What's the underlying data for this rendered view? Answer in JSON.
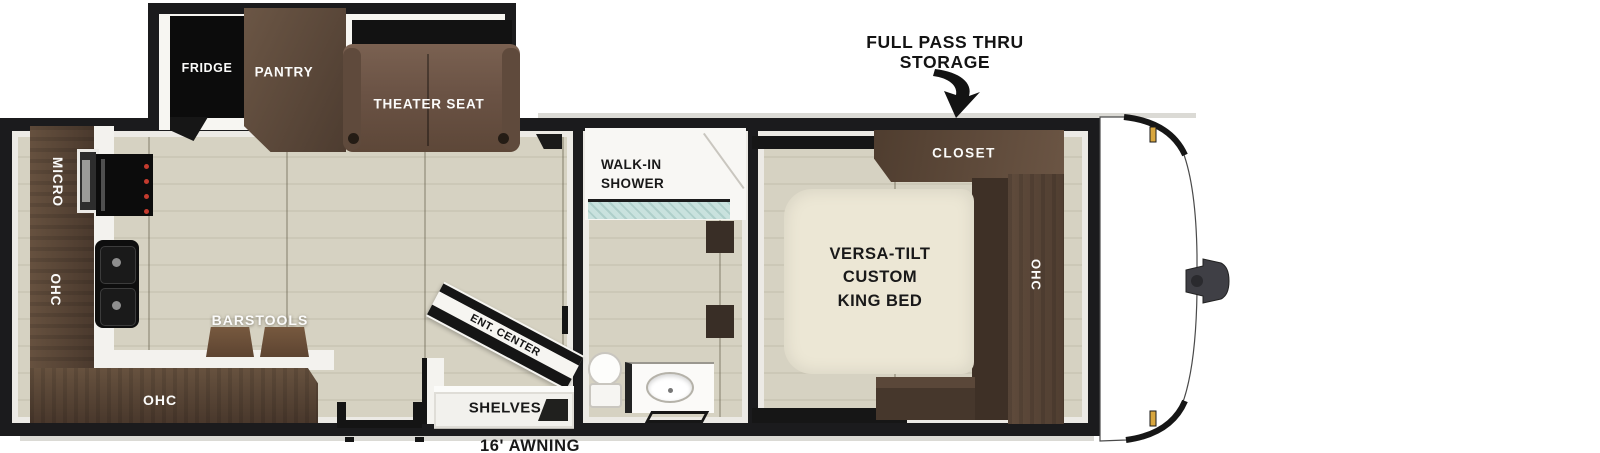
{
  "labels": {
    "storage1": "FULL PASS THRU",
    "storage2": "STORAGE",
    "awning": "16' AWNING"
  },
  "slideout": {
    "fridge": "FRIDGE",
    "pantry": "PANTRY",
    "theater_seat": "THEATER SEAT"
  },
  "kitchen": {
    "micro": "MICRO",
    "ohc_upper": "OHC",
    "barstools": "BARSTOOLS",
    "ohc_lower": "OHC",
    "ent_center": "ENT. CENTER",
    "shelves": "SHELVES"
  },
  "bath": {
    "shower1": "WALK-IN",
    "shower2": "SHOWER"
  },
  "bedroom": {
    "closet": "CLOSET",
    "bed1": "VERSA-TILT",
    "bed2": "CUSTOM",
    "bed3": "KING BED",
    "ohc": "OHC"
  },
  "colors": {
    "wall": "#1b1b1d",
    "floor": "#d6d2c2",
    "cabinet": "#5e4a3d",
    "cabinet_dark": "#41332b",
    "theater_seat": "#6e5647",
    "bed": "#ece7d5",
    "shower_glass": "#c9e2de",
    "marker_light": "#d8a63e",
    "label_light": "#fbfbfa",
    "label_dark": "#191919"
  }
}
